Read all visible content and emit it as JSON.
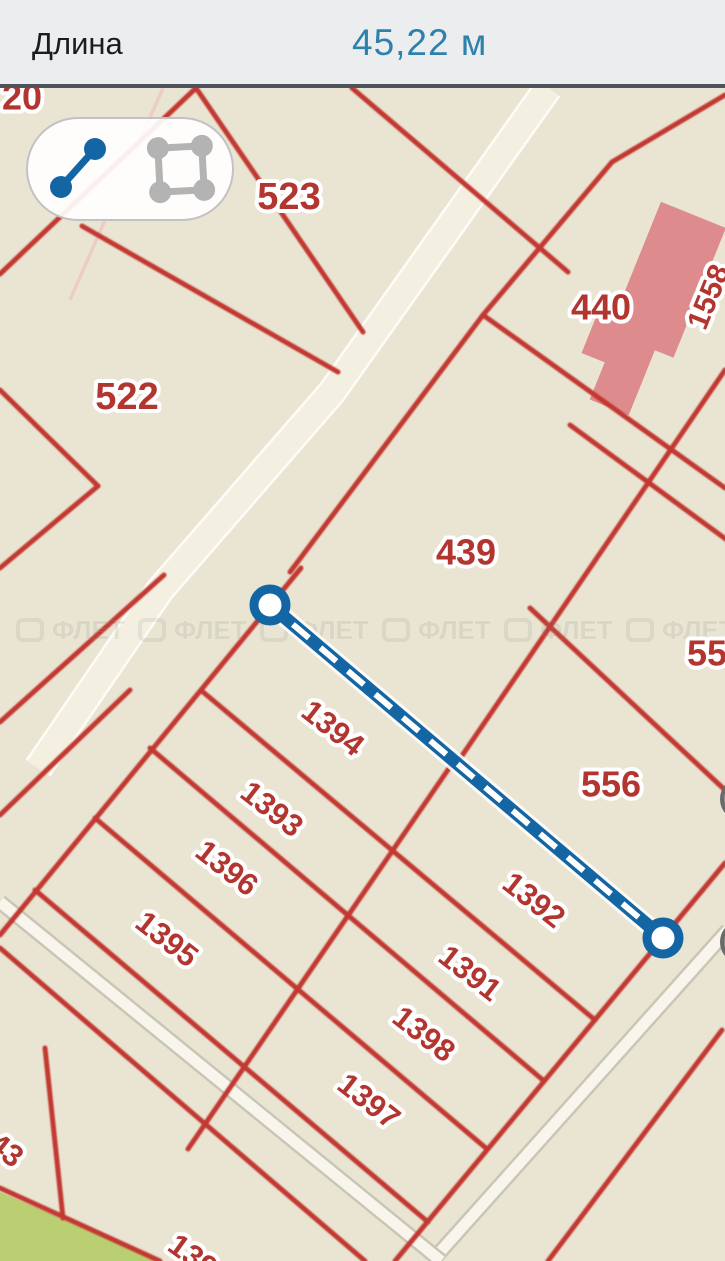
{
  "header": {
    "label": "Длина",
    "value": "45,22 м"
  },
  "toolbar": {
    "line_tool": "measure-line",
    "polygon_tool": "measure-area",
    "active_tool": "measure-line"
  },
  "measurement": {
    "length_value": "45,22 м",
    "start": {
      "x": 270,
      "y": 605
    },
    "end": {
      "x": 663,
      "y": 938
    }
  },
  "watermark": {
    "text": "ФЛЕТ",
    "repeats": 6
  },
  "colors": {
    "header_bg": "#ecedef",
    "header_divider": "#4e545c",
    "accent_blue": "#1465a3",
    "accent_blue_light": "#2e80ad",
    "map_bg": "#e9e5d2",
    "road_fill": "#f3f0e1",
    "parcel_line": "#c23730",
    "label_red": "#b23530",
    "building_pink": "#dd8b8c",
    "green_area": "#b9cf72",
    "icon_gray": "#b3b3b3"
  },
  "map": {
    "parcel_labels": [
      {
        "text": "20",
        "x": 22,
        "y": 97,
        "rot": 0,
        "fs": 36
      },
      {
        "text": "523",
        "x": 289,
        "y": 197,
        "rot": 0,
        "fs": 38
      },
      {
        "text": "522",
        "x": 127,
        "y": 397,
        "rot": 0,
        "fs": 38
      },
      {
        "text": "440",
        "x": 601,
        "y": 307,
        "rot": 0,
        "fs": 36
      },
      {
        "text": "1558",
        "x": 709,
        "y": 297,
        "rot": -68,
        "fs": 30
      },
      {
        "text": "439",
        "x": 466,
        "y": 552,
        "rot": 0,
        "fs": 36
      },
      {
        "text": "55",
        "x": 707,
        "y": 653,
        "rot": 0,
        "fs": 36
      },
      {
        "text": "556",
        "x": 611,
        "y": 784,
        "rot": 0,
        "fs": 36
      },
      {
        "text": "1394",
        "x": 333,
        "y": 728,
        "rot": 38,
        "fs": 31
      },
      {
        "text": "1393",
        "x": 272,
        "y": 809,
        "rot": 38,
        "fs": 31
      },
      {
        "text": "1396",
        "x": 227,
        "y": 868,
        "rot": 38,
        "fs": 31
      },
      {
        "text": "1395",
        "x": 167,
        "y": 939,
        "rot": 38,
        "fs": 31
      },
      {
        "text": "1392",
        "x": 534,
        "y": 900,
        "rot": 38,
        "fs": 31
      },
      {
        "text": "1391",
        "x": 470,
        "y": 973,
        "rot": 38,
        "fs": 31
      },
      {
        "text": "1398",
        "x": 424,
        "y": 1034,
        "rot": 38,
        "fs": 31
      },
      {
        "text": "1397",
        "x": 369,
        "y": 1101,
        "rot": 38,
        "fs": 31
      },
      {
        "text": "43",
        "x": 6,
        "y": 1150,
        "rot": 38,
        "fs": 31
      },
      {
        "text": "139",
        "x": 193,
        "y": 1256,
        "rot": 36,
        "fs": 31
      }
    ]
  }
}
